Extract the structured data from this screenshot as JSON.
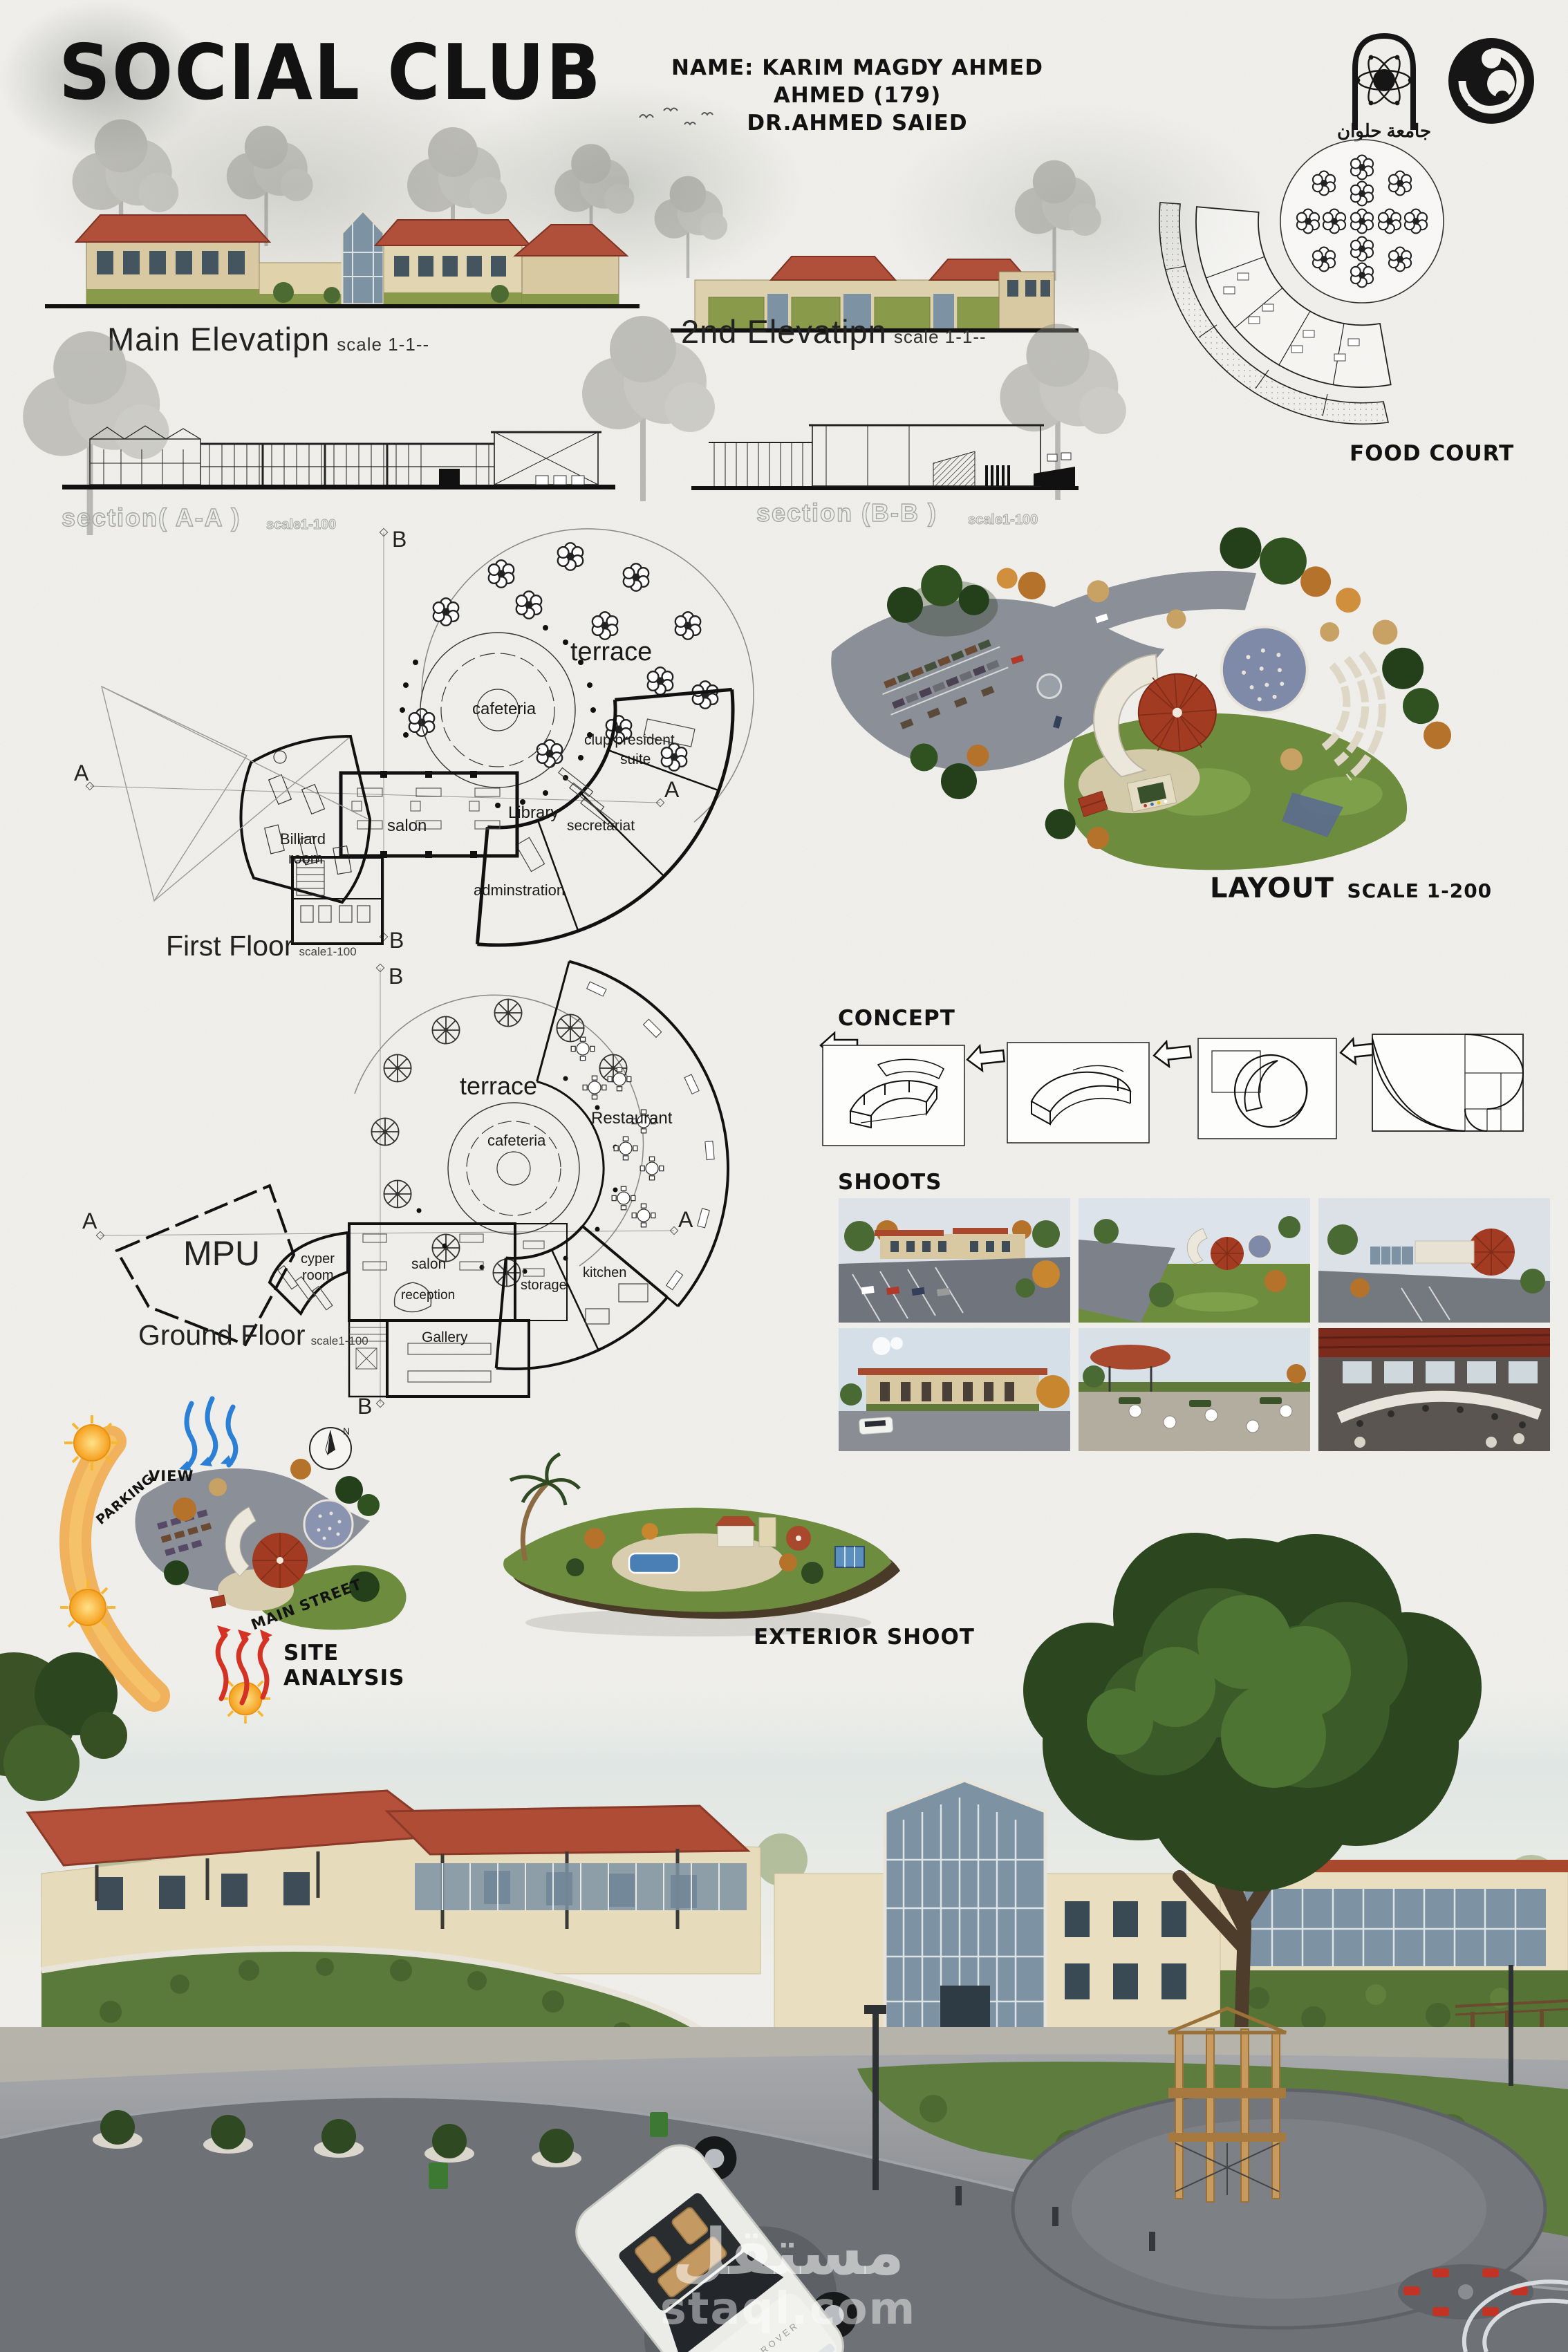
{
  "header": {
    "title": "SOCIAL CLUB",
    "name_line": "NAME: KARIM MAGDY AHMED AHMED (179)",
    "supervisor_line": "DR.AHMED SAIED",
    "university_caption": "جامعة حلوان"
  },
  "elevations": {
    "main": {
      "title": "Main Elevatipn",
      "scale": "scale 1-1--"
    },
    "second": {
      "title": "2nd Elevatipn",
      "scale": "scale 1-1--"
    }
  },
  "food_court": {
    "label": "FOOD COURT"
  },
  "sections": {
    "a_label": "section( A-A )",
    "a_scale": "scale1-100",
    "b_label": "section (B-B )",
    "b_scale": "scale1-100"
  },
  "first_floor": {
    "title": "First Floor",
    "scale": "scale1-100",
    "terrace": "terrace",
    "cafeteria": "cafeteria",
    "salon": "salon",
    "billiard_l1": "Billiard",
    "billiard_l2": "room",
    "library": "Library",
    "secretariat": "secretariat",
    "president_l1": "clup president",
    "president_l2": "suite",
    "administration": "adminstration",
    "axis_a": "A",
    "axis_b": "B"
  },
  "layout": {
    "title": "LAYOUT",
    "scale": "SCALE 1-200"
  },
  "concept": {
    "label": "CONCEPT"
  },
  "ground_floor": {
    "title": "Ground Floor",
    "scale": "scale1-100",
    "mpu": "MPU",
    "terrace": "terrace",
    "cafeteria": "cafeteria",
    "restaurant": "Restaurant",
    "salon": "salon",
    "reception": "reception",
    "gallery": "Gallery",
    "cyber_l1": "cyper",
    "cyber_l2": "room",
    "storage": "storage",
    "kitchen": "kitchen",
    "axis_a": "A",
    "axis_b": "B"
  },
  "shoots": {
    "label": "SHOOTS"
  },
  "site_analysis": {
    "title": "SITE ANALYSIS",
    "view": "VIEW",
    "parking": "PARKING",
    "main_street": "MAIN STREET",
    "north": "N"
  },
  "exterior": {
    "label": "EXTERIOR SHOOT"
  },
  "main_render": {
    "car_badge": "RANGE ROVER"
  },
  "watermark": {
    "arabic": "مستقل",
    "latin": "staql.com"
  },
  "colors": {
    "paper": "#f1f0ec",
    "ink": "#121212",
    "roof_red": "#b0503a",
    "wall_tan": "#d9c9a2",
    "hedge_green": "#8a9a4b",
    "lawn_green": "#6d8c3e",
    "tree_dark": "#2c4620",
    "tree_autumn": "#b5722a",
    "asphalt": "#8b8f98",
    "glass_blue": "#7d93a4",
    "sun_orange": "#f0a23a",
    "wind_blue": "#2b7fd4",
    "heat_red": "#d43224"
  }
}
